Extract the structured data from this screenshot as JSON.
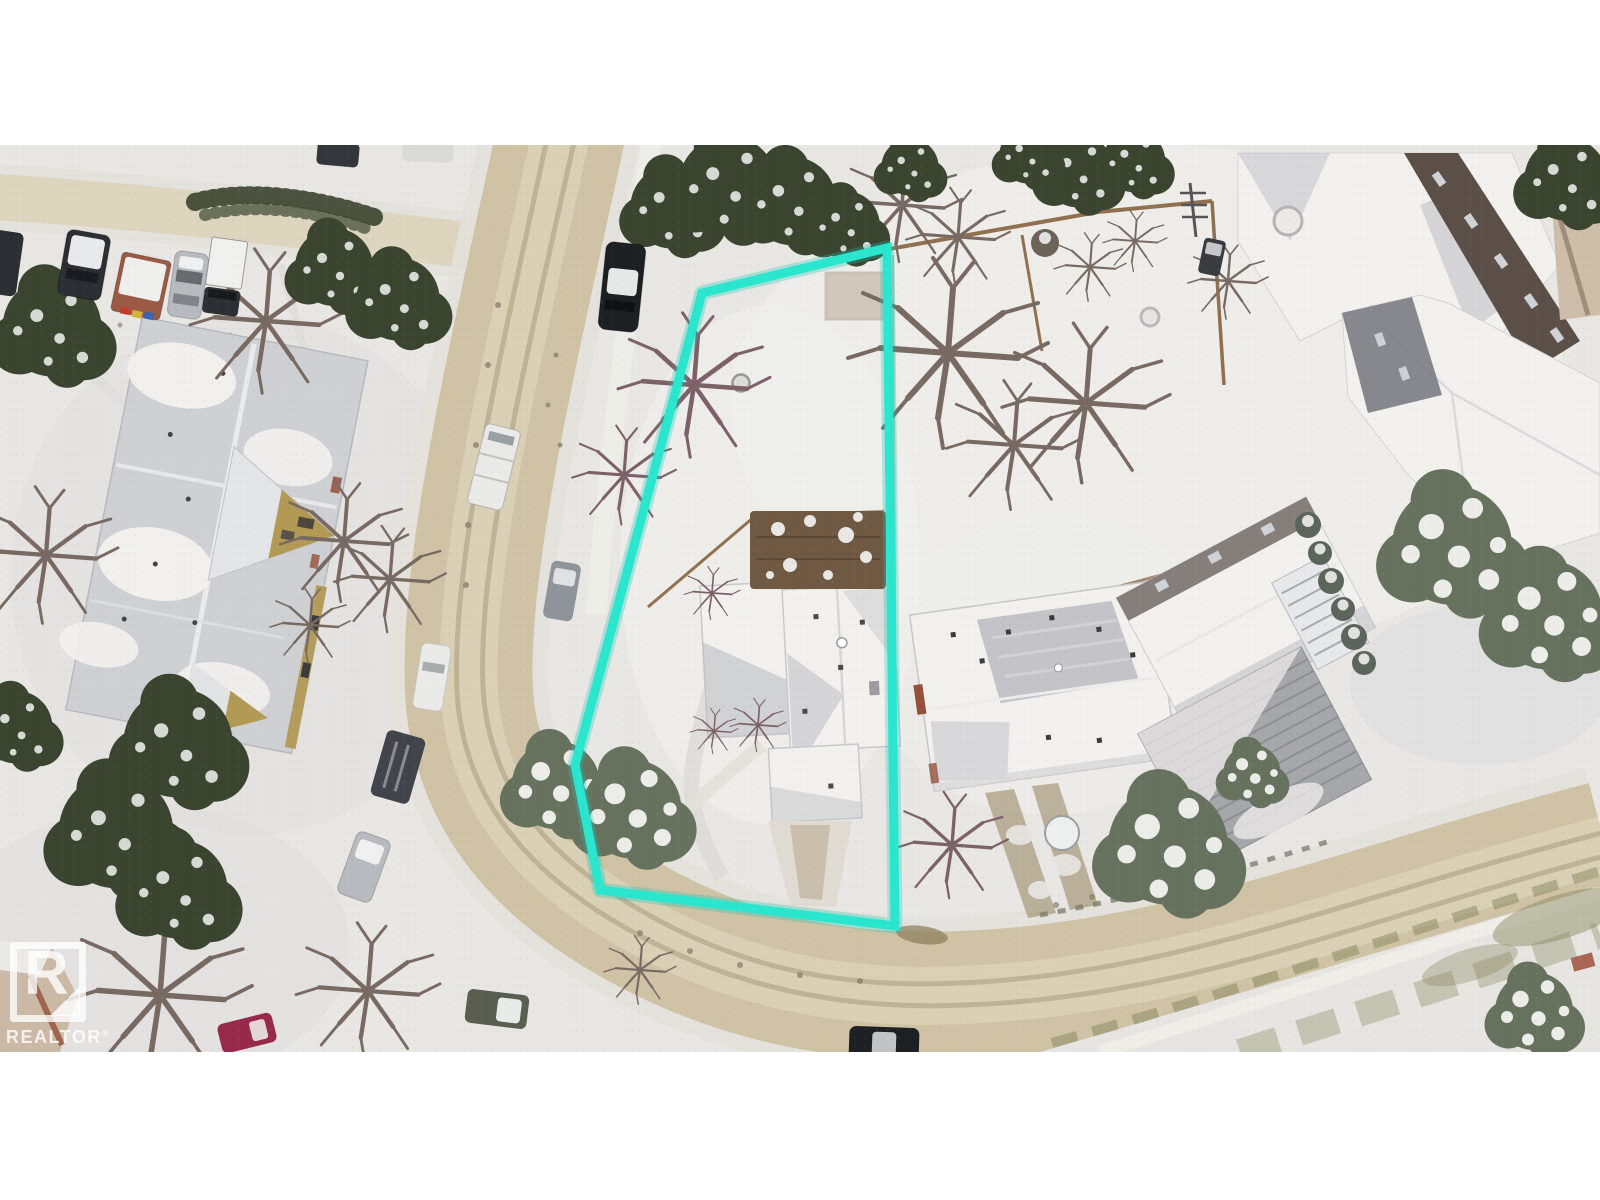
{
  "watermark": {
    "logo_letter": "R",
    "label": "REALTOR",
    "registered_symbol": "®"
  },
  "lot_outline": {
    "points": "702,148 887,103 895,781 600,745 575,620"
  },
  "palette": {
    "page_bg": "#ffffff",
    "snow": "#e9e7e4",
    "snow_bright": "#f3f2ef",
    "road": "#cfc2a5",
    "road_center": "#dcd2b9",
    "road_track": "#b5a88a",
    "road_halo": "#e3e1da",
    "sidewalk": "#efeeea",
    "grass": "#86855c",
    "lot_line": "#2ae6cf",
    "lot_line_glow": "#17c7b4",
    "evergreen": "#3a442f",
    "evergreen_snowy": "#67725e",
    "tree_bare": "#786a62",
    "tree_bare_purple": "#7d6168",
    "roof_white": "#f2f1ee",
    "roof_gray": "#cfd0d3",
    "roof_shadow": "#b7b8be",
    "roof_dark_band": "#5b4f48",
    "roof_ribbed": "#a6a7ab",
    "deck_brown": "#6f5943",
    "fence_brown": "#85633e",
    "wall_tan": "#b29a55",
    "wall_red": "#93503a",
    "car_dark": "#2b2e33",
    "car_black": "#1d2023",
    "car_silver": "#b7babe",
    "car_white": "#eaeae8",
    "car_gray": "#8f939a",
    "car_olive": "#5a5e50",
    "car_magenta": "#97294a",
    "car_van_dark": "#41444a",
    "trailer_red": "#9a5a44",
    "stripe_red": "#c23b2e",
    "stripe_yellow": "#d8b13a",
    "stripe_blue": "#3a62b0",
    "watermark_white": "rgba(255,255,255,0.78)"
  }
}
